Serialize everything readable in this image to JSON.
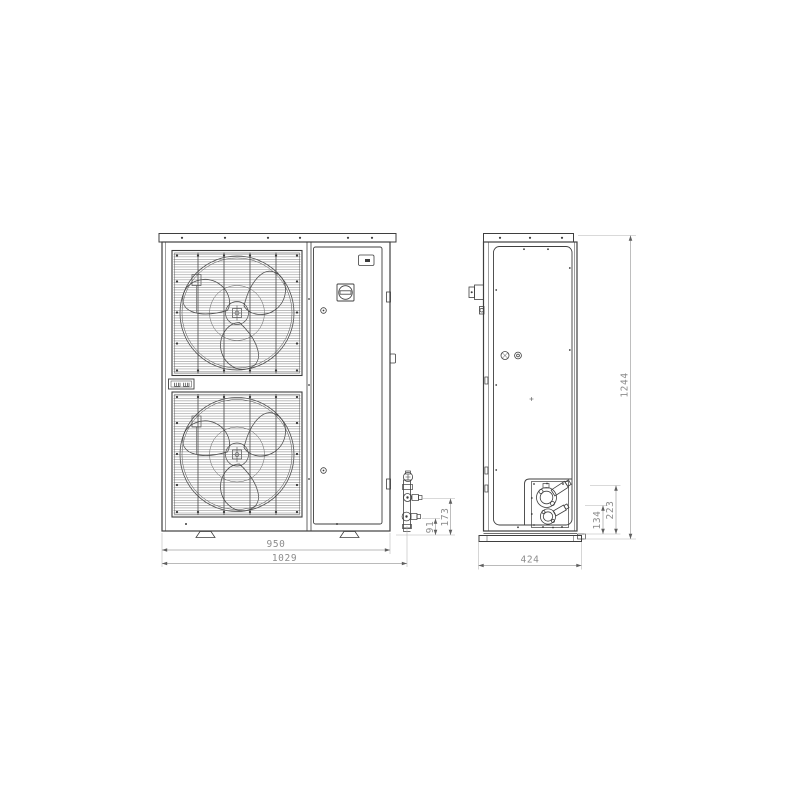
{
  "front_view": {
    "dim_mounting_width": "950",
    "dim_overall_width": "1029",
    "dim_suction_valve_height": "173",
    "dim_liquid_valve_height": "91"
  },
  "side_view": {
    "dim_depth": "424",
    "dim_overall_height": "1244",
    "dim_upper_connection_height": "223",
    "dim_lower_connection_height": "134"
  },
  "colors": {
    "background": "#ffffff",
    "drawing_line": "#3f3f3f",
    "dimension_line": "#a3a3a3",
    "dimension_text": "#8c8c8c"
  }
}
